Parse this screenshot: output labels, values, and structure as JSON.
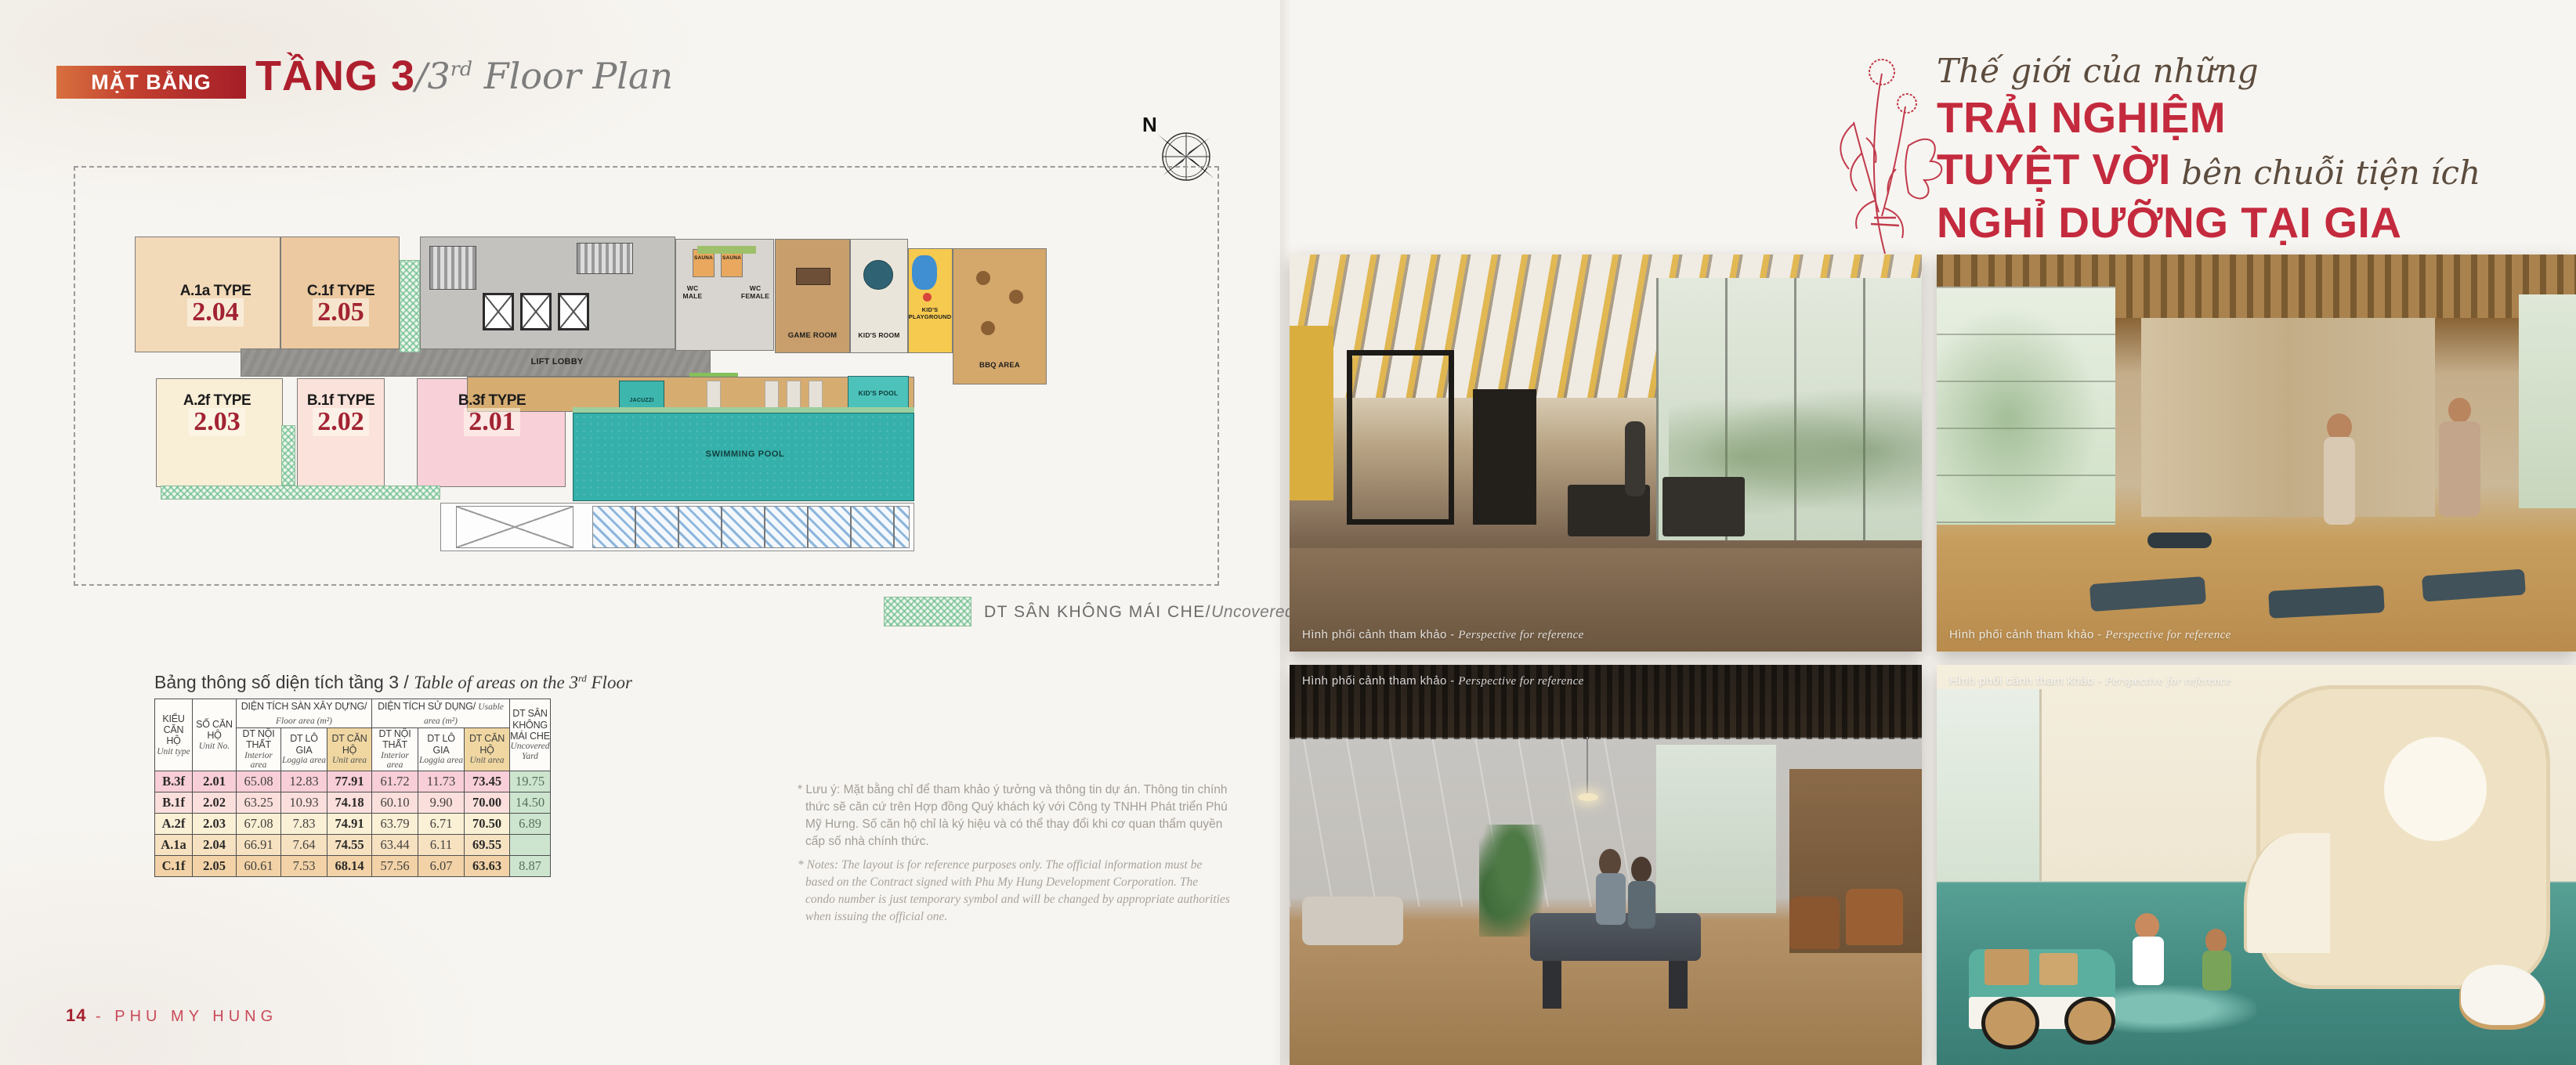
{
  "header": {
    "badge": "MẶT BẰNG",
    "floor": "TẦNG 3",
    "plan_slash": "/3",
    "plan_sup": "rd",
    "plan_rest": " Floor Plan"
  },
  "compass": {
    "n": "N"
  },
  "plan": {
    "units": [
      {
        "t": "A.1a TYPE",
        "n": "2.04"
      },
      {
        "t": "C.1f TYPE",
        "n": "2.05"
      },
      {
        "t": "A.2f TYPE",
        "n": "2.03"
      },
      {
        "t": "B.1f TYPE",
        "n": "2.02"
      },
      {
        "t": "B.3f TYPE",
        "n": "2.01"
      }
    ],
    "rooms": {
      "lift_lobby": "LIFT LOBBY",
      "sauna": "SAUNA",
      "wc_male": "WC\nMALE",
      "wc_female": "WC\nFEMALE",
      "game_room": "GAME ROOM",
      "kids_room": "KID'S ROOM",
      "kids_playground": "KID'S\nPLAYGROUND",
      "bbq_area": "BBQ AREA",
      "kids_pool": "KID'S POOL",
      "swimming_pool": "SWIMMING POOL",
      "jacuzzi": "JACUZZI"
    }
  },
  "legend": {
    "vn": "DT SÂN KHÔNG MÁI CHE/",
    "en": "Uncovered Yard"
  },
  "table": {
    "title_vn": "Bảng thông số diện tích tầng 3 / ",
    "title_en_pre": "Table of areas on the 3",
    "title_en_sup": "rd",
    "title_en_post": " Floor",
    "h": {
      "unit_type_vn": "KIỂU CĂN HỘ",
      "unit_type_en": "Unit type",
      "unit_no_vn": "SỐ CĂN HỘ",
      "unit_no_en": "Unit No.",
      "floor_vn": "DIỆN TÍCH SÀN XÂY DỰNG/ ",
      "floor_en": "Floor area (m²)",
      "usable_vn": "DIỆN TÍCH SỬ DỤNG/ ",
      "usable_en": "Usable area (m²)",
      "interior_vn": "DT NỘI THẤT",
      "interior_en": "Interior area",
      "loggia_vn": "DT LÔ GIA",
      "loggia_en": "Loggia area",
      "unit_vn": "DT CĂN HỘ",
      "unit_en": "Unit area",
      "yard_vn": "DT SÂN\nKHÔNG\nMÁI CHE",
      "yard_en": "Uncovered Yard"
    },
    "rows": [
      {
        "cells": [
          "B.3f",
          "2.01",
          "65.08",
          "12.83",
          "77.91",
          "61.72",
          "11.73",
          "73.45",
          "19.75"
        ]
      },
      {
        "cells": [
          "B.1f",
          "2.02",
          "63.25",
          "10.93",
          "74.18",
          "60.10",
          "9.90",
          "70.00",
          "14.50"
        ]
      },
      {
        "cells": [
          "A.2f",
          "2.03",
          "67.08",
          "7.83",
          "74.91",
          "63.79",
          "6.71",
          "70.50",
          "6.89"
        ]
      },
      {
        "cells": [
          "A.1a",
          "2.04",
          "66.91",
          "7.64",
          "74.55",
          "63.44",
          "6.11",
          "69.55",
          ""
        ]
      },
      {
        "cells": [
          "C.1f",
          "2.05",
          "60.61",
          "7.53",
          "68.14",
          "57.56",
          "6.07",
          "63.63",
          "8.87"
        ]
      }
    ]
  },
  "notes": {
    "vn": "* Lưu ý: Mặt bằng chỉ để tham khảo ý tưởng và thông tin dự án. Thông tin chính thức sẽ căn cứ trên Hợp đồng Quý khách ký với Công ty TNHH Phát triển Phú Mỹ Hưng. Số căn hộ chỉ là ký hiệu và có thể thay đổi khi cơ quan thẩm quyền cấp số nhà chính thức.",
    "en": "* Notes: The layout is for reference purposes only. The official information must be based on the Contract signed with Phu My Hung Development Corporation. The condo number is just temporary symbol and will be changed by appropriate authorities when issuing the official one."
  },
  "right_page": {
    "script1": "Thế giới của những",
    "red1": "TRẢI NGHIỆM",
    "red2": "TUYỆT VỜI",
    "script2": " bên chuỗi tiện ích",
    "red3": "NGHỈ DƯỠNG TẠI GIA",
    "sub1": "A World Of Amazing Experiences With The At-Home",
    "sub2": "Resort Amenity Chain",
    "caption_vn": "Hình phối cảnh tham khảo - ",
    "caption_en": "Perspective for reference"
  },
  "footer": {
    "num": "14",
    "sep": " - ",
    "brand": "PHU MY HUNG"
  },
  "colors": {
    "accent_red": "#b01f2e",
    "highlight_tan": "#f0d7a2",
    "yard_green": "#cde5cf",
    "pool_teal": "#35b0aa"
  }
}
